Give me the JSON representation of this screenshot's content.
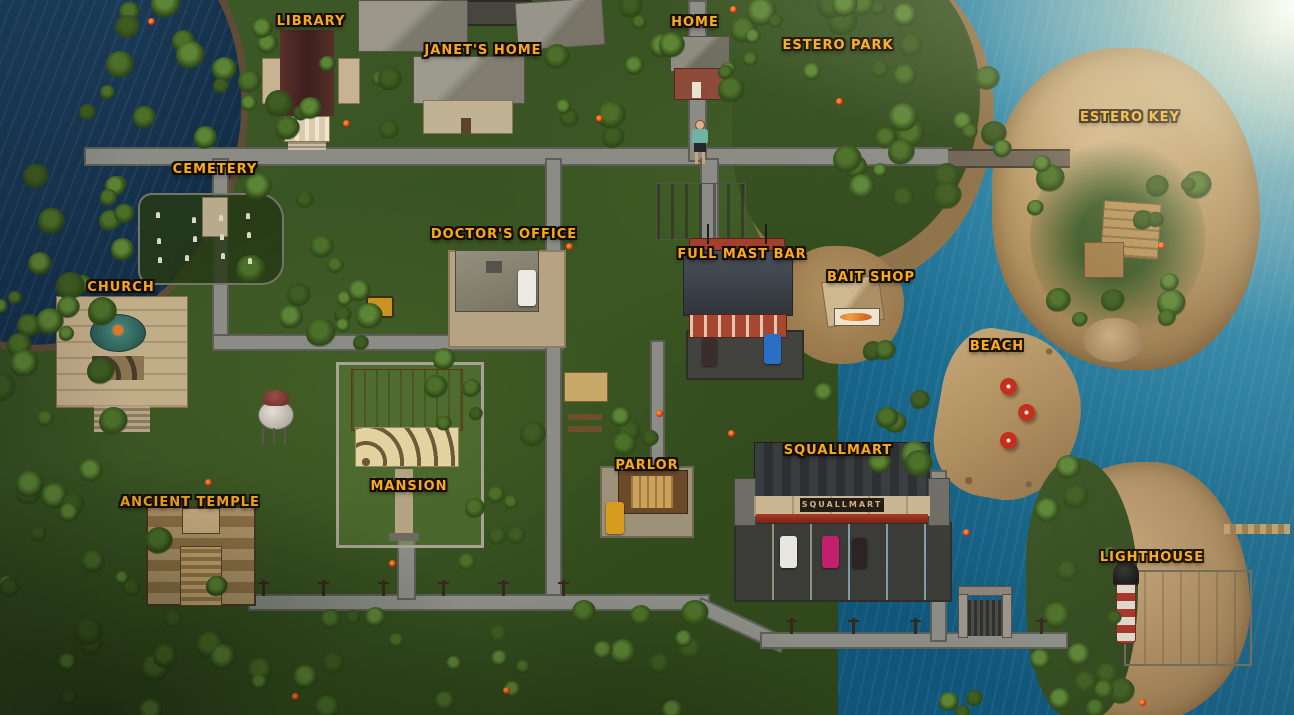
{
  "game_map": {
    "locations": [
      {
        "id": "library",
        "label": "LIBRARY",
        "cx": 311,
        "y": 15
      },
      {
        "id": "janets-home",
        "label": "JANET'S HOME",
        "cx": 483,
        "y": 44
      },
      {
        "id": "home",
        "label": "HOME",
        "cx": 695,
        "y": 16
      },
      {
        "id": "estero-park",
        "label": "ESTERO PARK",
        "cx": 838,
        "y": 39
      },
      {
        "id": "estero-key",
        "label": "ESTERO KEY",
        "cx": 1130,
        "y": 111
      },
      {
        "id": "cemetery",
        "label": "CEMETERY",
        "cx": 215,
        "y": 163
      },
      {
        "id": "doctors-office",
        "label": "DOCTOR'S OFFICE",
        "cx": 504,
        "y": 228
      },
      {
        "id": "full-mast-bar",
        "label": "FULL MAST BAR",
        "cx": 742,
        "y": 248
      },
      {
        "id": "bait-shop",
        "label": "BAIT SHOP",
        "cx": 871,
        "y": 271
      },
      {
        "id": "church",
        "label": "CHURCH",
        "cx": 121,
        "y": 281
      },
      {
        "id": "beach",
        "label": "BEACH",
        "cx": 997,
        "y": 340
      },
      {
        "id": "squallmart",
        "label": "SQUALLMART",
        "cx": 838,
        "y": 444
      },
      {
        "id": "parlor",
        "label": "PARLOR",
        "cx": 647,
        "y": 459
      },
      {
        "id": "mansion",
        "label": "MANSION",
        "cx": 409,
        "y": 480
      },
      {
        "id": "ancient-temple",
        "label": "ANCIENT TEMPLE",
        "cx": 190,
        "y": 496
      },
      {
        "id": "lighthouse",
        "label": "LIGHTHOUSE",
        "cx": 1152,
        "y": 551
      }
    ],
    "signs": {
      "squallmart_storefront": "SQUALLMART"
    },
    "colors": {
      "label_gold": "#f9a91e",
      "ocean_dark": "#16334e",
      "ocean_tropical": "#1f7396",
      "sand": "#b3925f",
      "road_gray": "#8b8c86",
      "jungle_green": "#36501f"
    }
  }
}
